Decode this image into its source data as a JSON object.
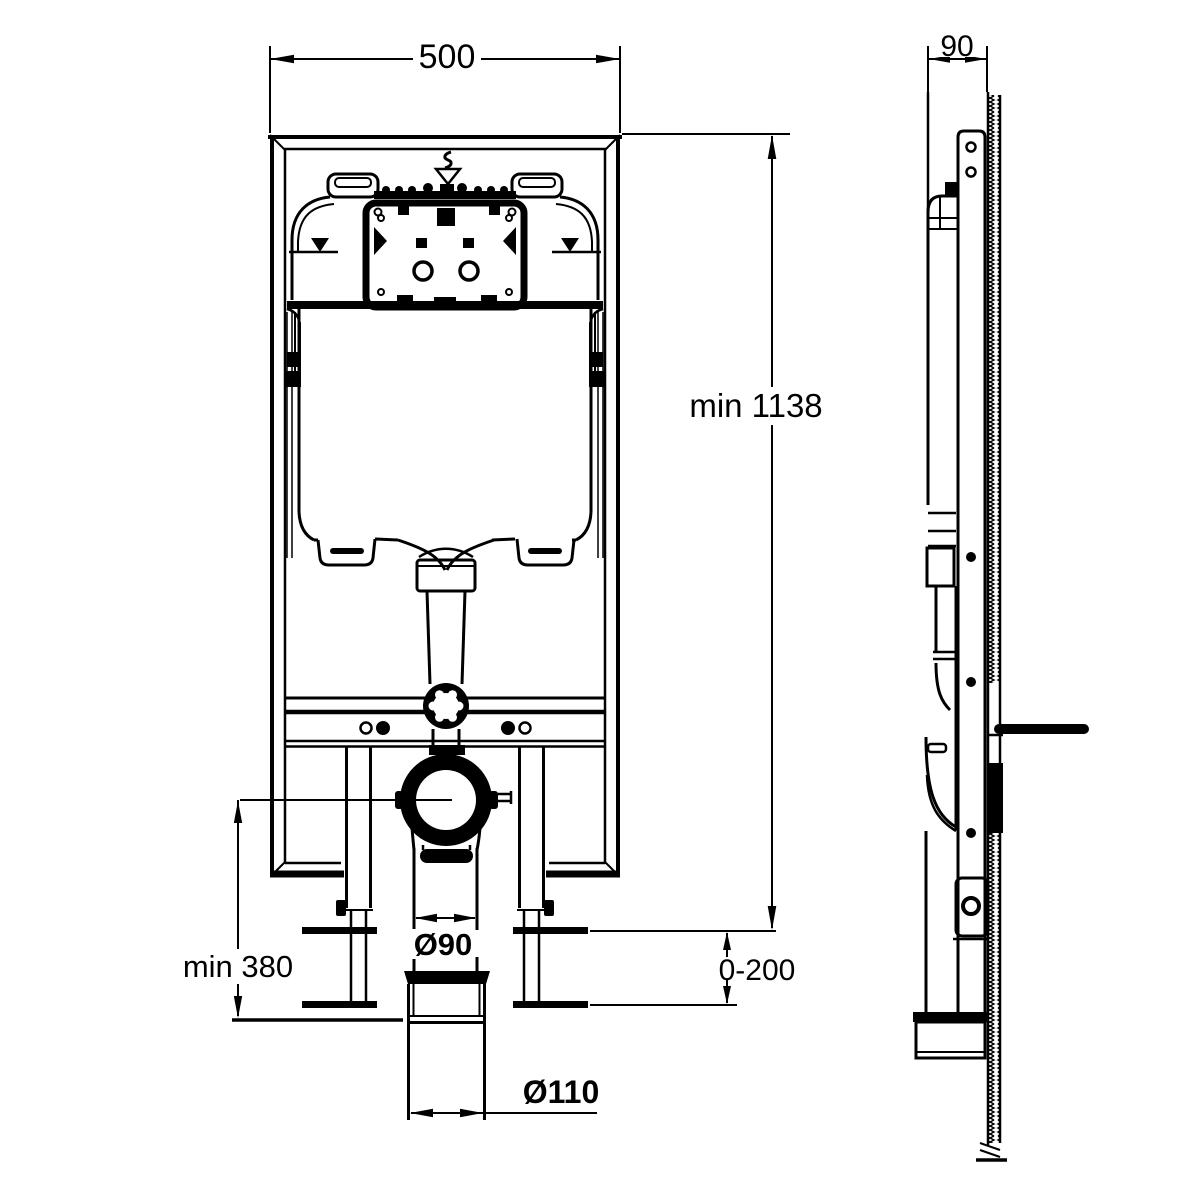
{
  "drawing": {
    "title": "concealed-cistern-frame-installation-drawing",
    "background_color": "#ffffff",
    "line_color": "#000000",
    "dimensions": {
      "frame_width": "500",
      "frame_depth": "90",
      "frame_height": "min 1138",
      "outlet_height": "min 380",
      "foot_adjustment": "0-200",
      "flush_bend_diameter": "Ø90",
      "soil_pipe_diameter": "Ø110"
    },
    "views": {
      "front": "front view of frame with cistern, access panel, flush pipe, outlet clamp, soil pipe and adjustable feet",
      "side": "side profile against hatched wall with mounting bracket"
    }
  }
}
